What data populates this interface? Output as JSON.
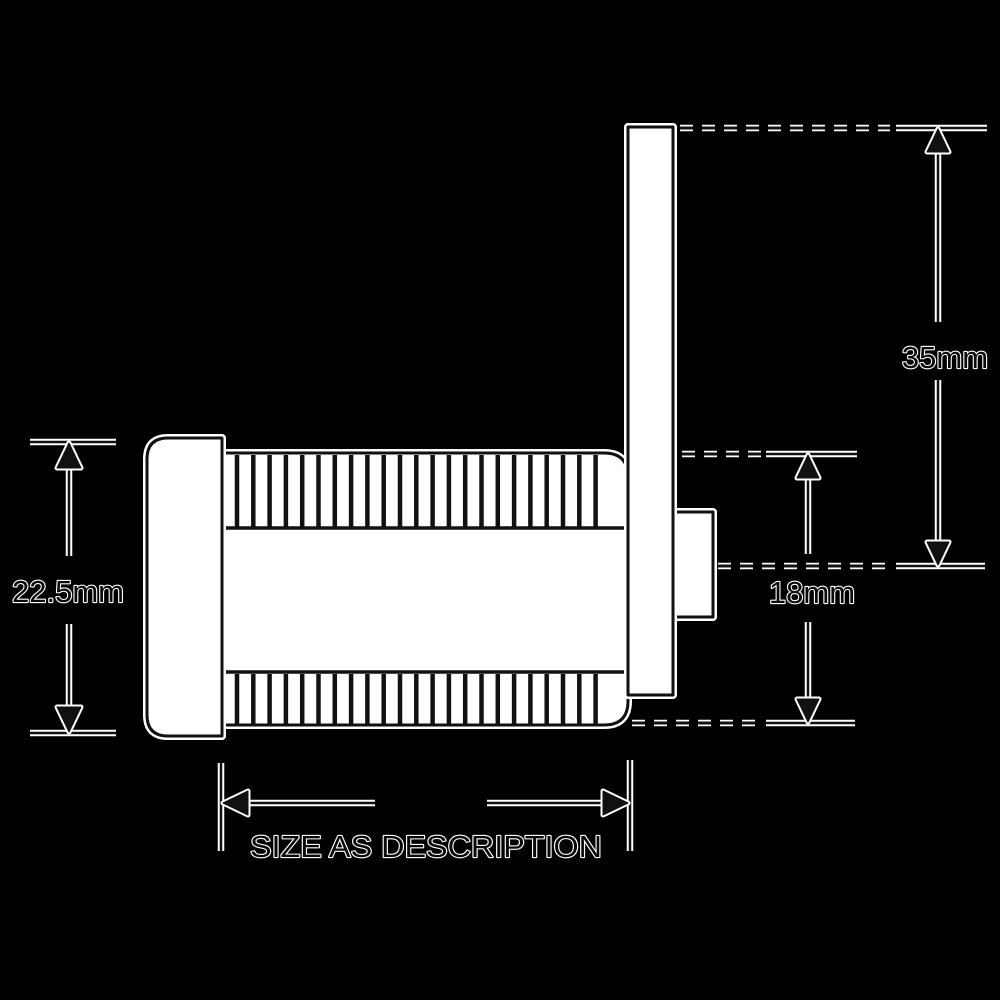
{
  "page": {
    "background_color": "#000000"
  },
  "drawing": {
    "stroke_color": "#111111",
    "fill_color": "#ffffff",
    "halo_color": "#ffffff",
    "labels": {
      "cam_height": "35mm",
      "fixing_height": "18mm",
      "body_diameter": "22.5mm",
      "body_length": "SIZE AS DESCRIPTION"
    }
  }
}
